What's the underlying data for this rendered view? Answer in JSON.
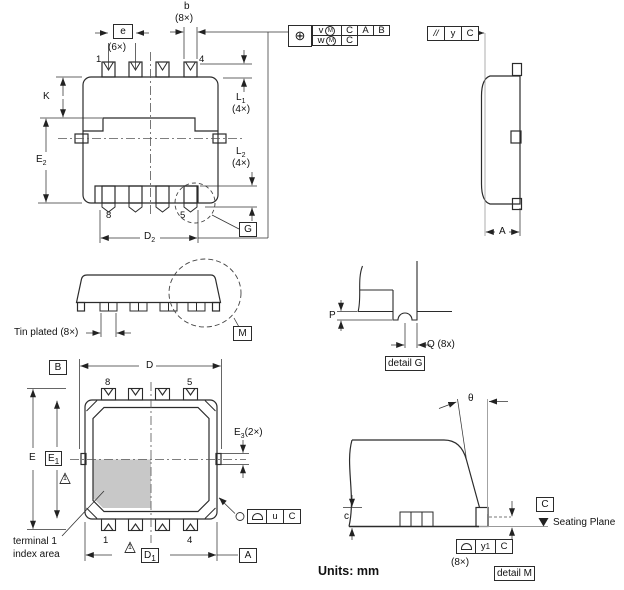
{
  "units_label": "Units: mm",
  "top_view": {
    "pin1": "1",
    "pin4": "4",
    "pin8": "8",
    "pin5": "5",
    "dim_b": "b",
    "dim_b_count": "(8×)",
    "dim_e": "e",
    "dim_e_count": "(6×)",
    "dim_k": "K",
    "dim_l1": "L",
    "dim_l1_sub": "1",
    "dim_l1_count": "(4×)",
    "dim_l2": "L",
    "dim_l2_sub": "2",
    "dim_l2_count": "(4×)",
    "dim_e2": "E",
    "dim_e2_sub": "2",
    "dim_d2": "D",
    "dim_d2_sub": "2",
    "detail_g_ref": "G"
  },
  "tolerance_frames": {
    "position_symbol": "⊕",
    "row1_value": "v",
    "row1_modifier": "M",
    "row1_datum1": "C",
    "row1_datum2": "A",
    "row1_datum3": "B",
    "row2_value": "w",
    "row2_modifier": "M",
    "row2_datum1": "C",
    "parallelism_symbol": "//",
    "parallelism_value": "y",
    "parallelism_datum": "C"
  },
  "side_view": {
    "dim_a": "A"
  },
  "front_view": {
    "tin_plated": "Tin plated (8×)",
    "detail_m_ref": "M"
  },
  "detail_g": {
    "dim_p": "P",
    "dim_q": "Q (8x)",
    "caption": "detail G"
  },
  "bottom_view": {
    "datum_b": "B",
    "datum_a": "A",
    "dim_d": "D",
    "dim_e": "E",
    "dim_e1": "E",
    "dim_e1_sub": "1",
    "dim_e3": "E",
    "dim_e3_sub": "3",
    "dim_e3_count": "(2×)",
    "dim_d1": "D",
    "dim_d1_sub": "1",
    "pin8": "8",
    "pin5": "5",
    "pin1": "1",
    "pin4": "4",
    "note_flag": "1",
    "terminal_line1": "terminal 1",
    "terminal_line2": "index area",
    "profile_value": "u",
    "profile_datum": "C"
  },
  "detail_m": {
    "dim_theta": "θ",
    "dim_c": "c",
    "datum_c": "C",
    "seating_plane": "Seating Plane",
    "profile_value": "y",
    "profile_value_sub": "1",
    "profile_datum": "C",
    "profile_count": "(8×)",
    "caption": "detail M"
  }
}
